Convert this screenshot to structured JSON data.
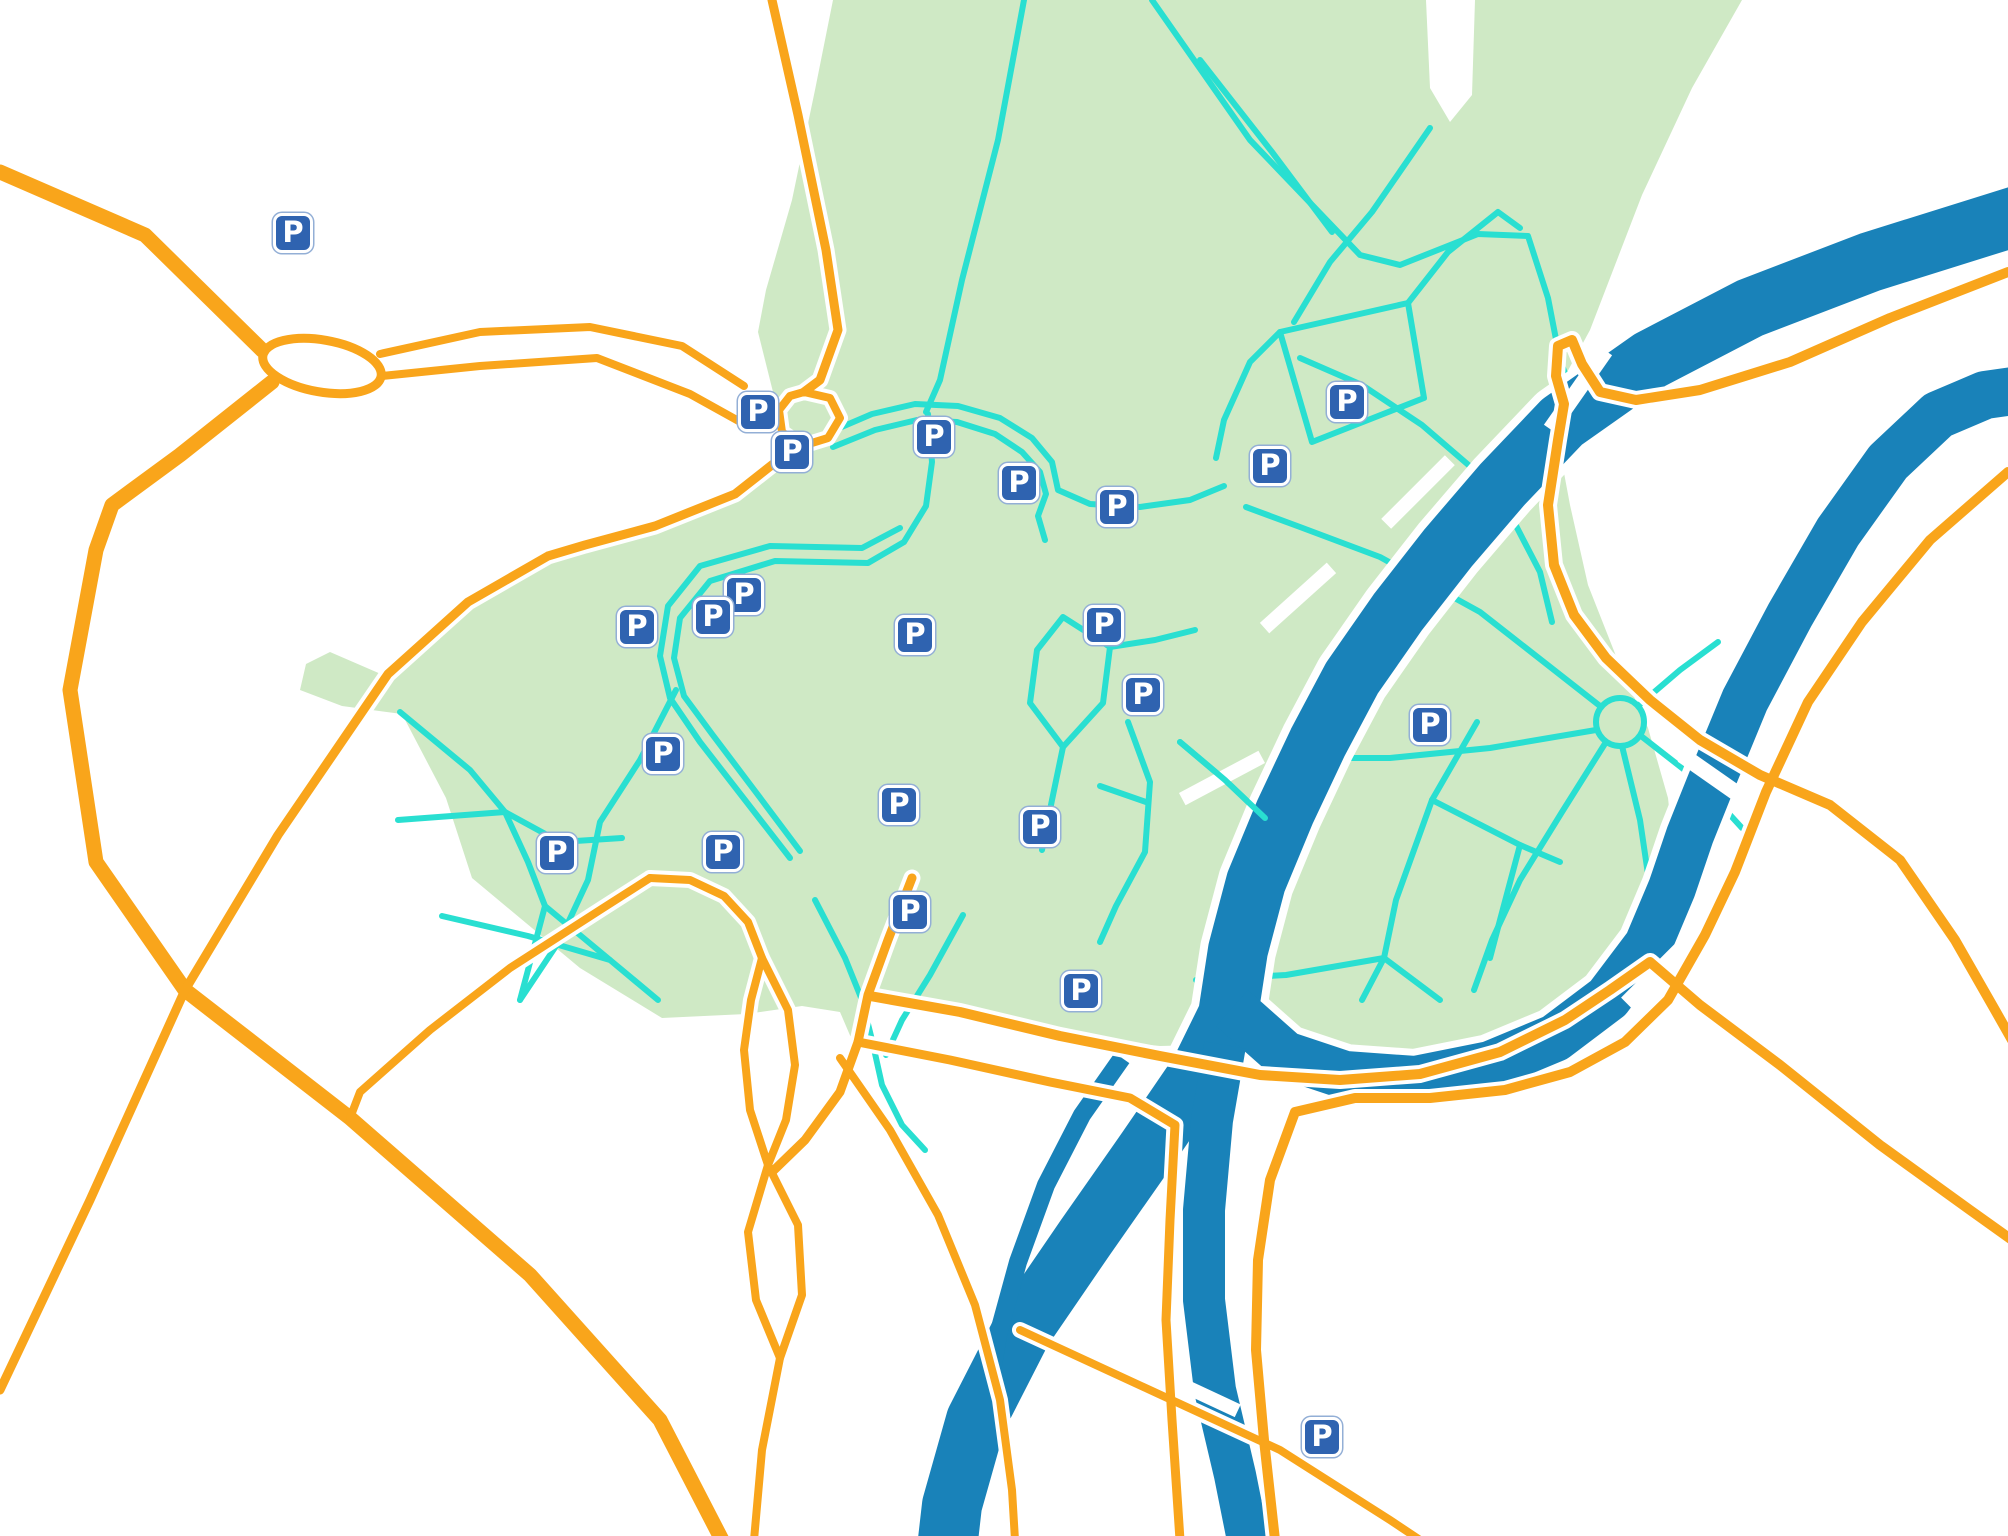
{
  "colors": {
    "background": "#ffffff",
    "park_fill": "#cfe9c5",
    "trail": "#29dfd1",
    "road": "#f9a51b",
    "road_casing": "#ffffff",
    "river": "#1982b9",
    "marker_background": "#2f63b0",
    "marker_border": "#ffffff",
    "marker_text": "#ffffff",
    "marker_outline": "#93afd6"
  },
  "map": {
    "marker_label": "P",
    "parking_markers": [
      {
        "x": 293,
        "y": 233
      },
      {
        "x": 758,
        "y": 412
      },
      {
        "x": 792,
        "y": 452
      },
      {
        "x": 934,
        "y": 437
      },
      {
        "x": 1019,
        "y": 483
      },
      {
        "x": 1117,
        "y": 507
      },
      {
        "x": 1270,
        "y": 466
      },
      {
        "x": 1347,
        "y": 402
      },
      {
        "x": 744,
        "y": 595
      },
      {
        "x": 713,
        "y": 617
      },
      {
        "x": 637,
        "y": 627
      },
      {
        "x": 915,
        "y": 635
      },
      {
        "x": 1104,
        "y": 625
      },
      {
        "x": 1143,
        "y": 695
      },
      {
        "x": 1430,
        "y": 725
      },
      {
        "x": 663,
        "y": 754
      },
      {
        "x": 557,
        "y": 853
      },
      {
        "x": 723,
        "y": 852
      },
      {
        "x": 899,
        "y": 805
      },
      {
        "x": 1040,
        "y": 827
      },
      {
        "x": 910,
        "y": 912
      },
      {
        "x": 1081,
        "y": 991
      },
      {
        "x": 1322,
        "y": 1437
      }
    ]
  }
}
